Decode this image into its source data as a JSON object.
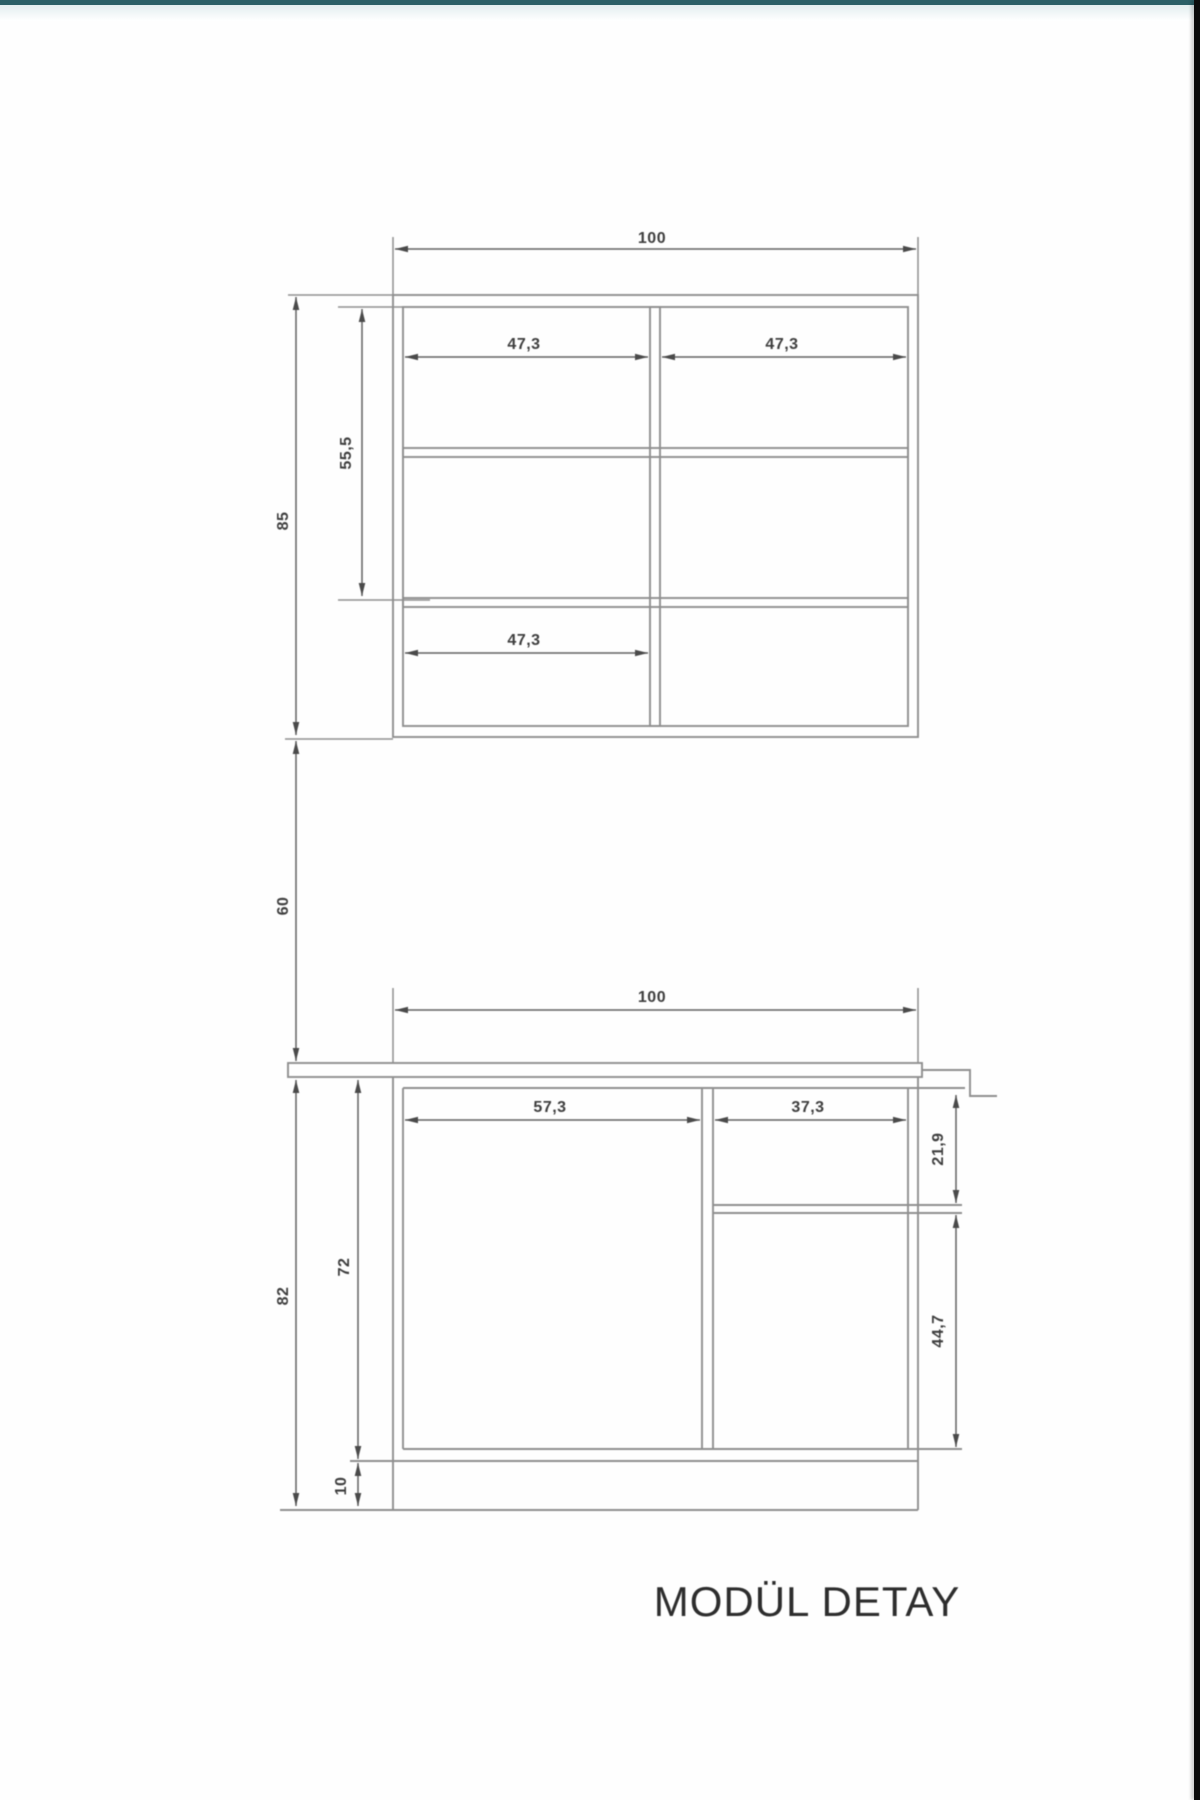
{
  "page": {
    "title_label": "MODÜL DETAY"
  },
  "colors": {
    "line": "#8f8f8f",
    "dimension": "#606060",
    "text": "#3e3e3e",
    "title": "#2d2d2d",
    "top_strip": "#2c6067",
    "right_strip": "#0b0b0b",
    "background": "#fefefe"
  },
  "drawing": {
    "upper_cabinet": {
      "width_label": "100",
      "height_label": "85",
      "interior_height_label": "55,5",
      "top_left_bay_label": "47,3",
      "top_right_bay_label": "47,3",
      "bottom_left_bay_label": "47,3"
    },
    "gap": {
      "height_label": "60"
    },
    "lower_cabinet": {
      "width_label": "100",
      "height_label": "82",
      "carcass_height_label": "72",
      "plinth_height_label": "10",
      "left_bay_label": "57,3",
      "right_bay_label": "37,3",
      "drawer_section_label": "21,9",
      "door_section_label": "44,7"
    }
  }
}
